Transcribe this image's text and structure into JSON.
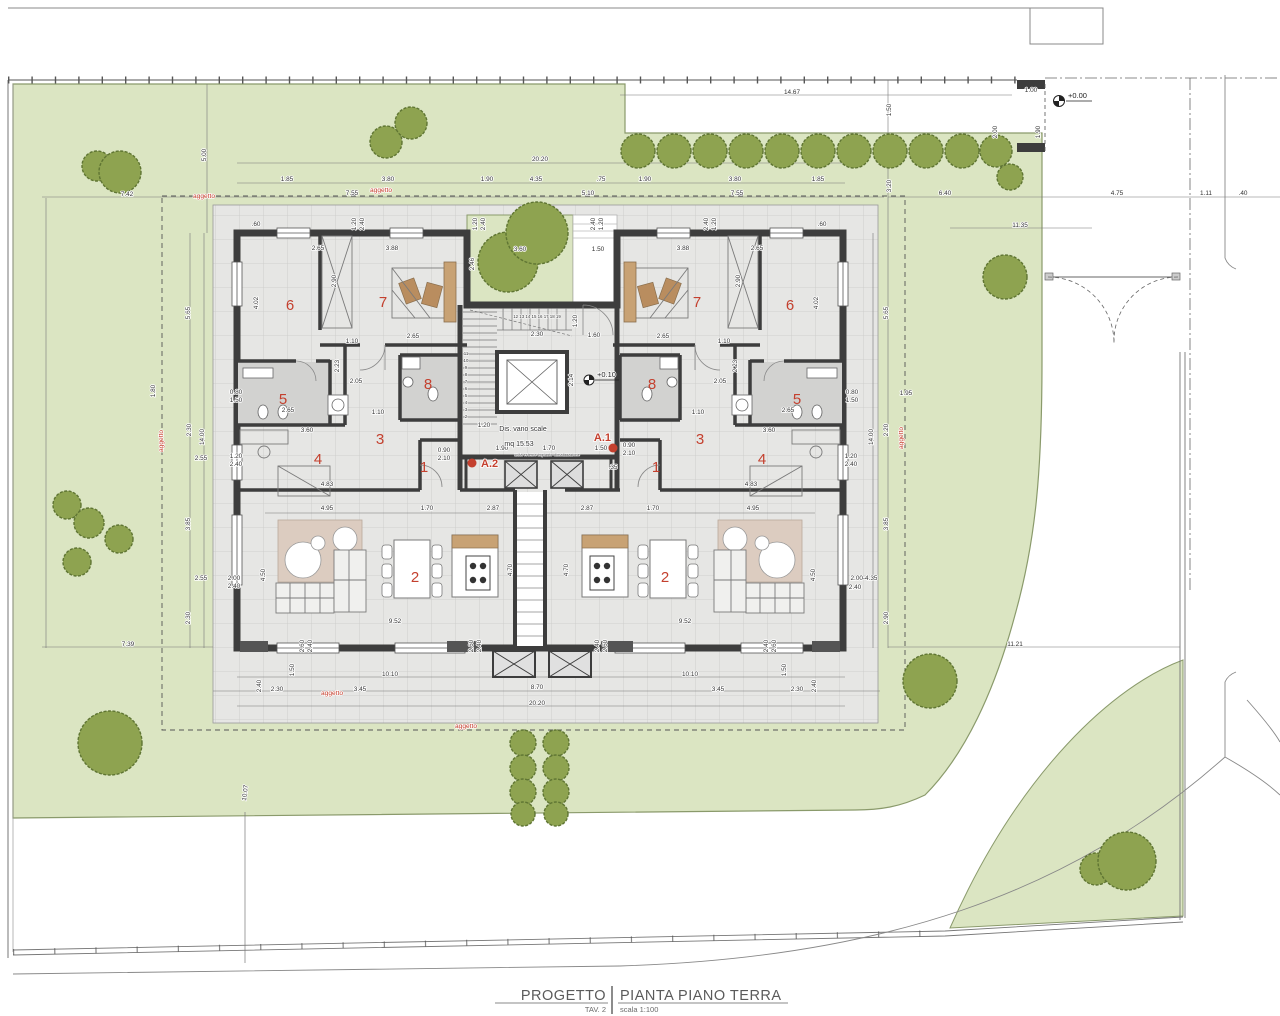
{
  "title_block": {
    "project_label": "PROGETTO",
    "drawing_title": "PIANTA PIANO TERRA",
    "sheet_label": "TAV. 2",
    "scale_label": "scala 1:100"
  },
  "notes": {
    "stair_line1": "Dis. vano scale",
    "stair_line2": "mq 15.53",
    "ac_units": "unità esterne impianto climatizzazione",
    "stair_top_numbers": "12 13 14 15 16 17 18 19"
  },
  "levels": {
    "ground": "+0.00",
    "entry": "+0.10"
  },
  "entrances": {
    "right": "A.1",
    "left": "A.2"
  },
  "colors": {
    "lawn": "#dbe5c2",
    "lawn_edge": "#8a9a6b",
    "tree_fill": "#8ea350",
    "tree_edge": "#5f7533",
    "paving": "#e6e6e4",
    "paving_grid": "#c9c9c7",
    "wall": "#3d3d3d",
    "red": "#c4402e",
    "bath_floor": "#d2d2d0",
    "wood": "#c8a274",
    "rug": "#dcccc0"
  },
  "annotations": {
    "dims": [
      [
        "14.67",
        792,
        94,
        0
      ],
      [
        "1.50",
        891,
        110,
        -90
      ],
      [
        "5.00",
        206,
        155,
        -90
      ],
      [
        "20.20",
        540,
        161,
        0
      ],
      [
        "1.85",
        287,
        181,
        0
      ],
      [
        "3.80",
        388,
        181,
        0
      ],
      [
        "1.90",
        487,
        181,
        0
      ],
      [
        "4.35",
        536,
        181,
        0
      ],
      [
        ".75",
        601,
        181,
        0
      ],
      [
        "1.90",
        645,
        181,
        0
      ],
      [
        "3.80",
        735,
        181,
        0
      ],
      [
        "1.85",
        818,
        181,
        0
      ],
      [
        "7.42",
        127,
        196,
        0
      ],
      [
        "7.55",
        352,
        195,
        0
      ],
      [
        "5.10",
        588,
        195,
        0
      ],
      [
        "7.55",
        737,
        195,
        0
      ],
      [
        "6.40",
        945,
        195,
        0
      ],
      [
        "3.20",
        891,
        186,
        -90
      ],
      [
        "4.75",
        1117,
        195,
        0
      ],
      [
        "1.11",
        1206,
        195,
        0
      ],
      [
        ".40",
        1243,
        195,
        0
      ],
      [
        "1.00",
        1031,
        92,
        0
      ],
      [
        "2.00",
        997,
        132,
        -90
      ],
      [
        "1.90",
        1040,
        132,
        -90
      ],
      [
        "11.35",
        1020,
        227,
        0
      ],
      [
        "5.65",
        190,
        313,
        -90
      ],
      [
        "1.80",
        155,
        391,
        -90
      ],
      [
        "0.80",
        236,
        394,
        0
      ],
      [
        "1.50",
        236,
        402,
        0
      ],
      [
        "2.30",
        191,
        430,
        -90
      ],
      [
        "14.00",
        204,
        437,
        -90
      ],
      [
        "2.55",
        201,
        460,
        0
      ],
      [
        "1.20",
        236,
        458,
        0
      ],
      [
        "2.40",
        236,
        466,
        0
      ],
      [
        "3.85",
        190,
        524,
        -90
      ],
      [
        "2.55",
        201,
        580,
        0
      ],
      [
        "2.00",
        234,
        580,
        0
      ],
      [
        "2.40",
        234,
        588,
        0
      ],
      [
        "2.30",
        190,
        618,
        -90
      ],
      [
        "7.39",
        128,
        646,
        0
      ],
      [
        "5.65",
        888,
        313,
        -90
      ],
      [
        "1.95",
        906,
        395,
        0
      ],
      [
        "0.80",
        852,
        394,
        0
      ],
      [
        "1.50",
        852,
        402,
        0
      ],
      [
        "2.20",
        888,
        430,
        -90
      ],
      [
        "14.00",
        873,
        437,
        -90
      ],
      [
        "1.20",
        851,
        458,
        0
      ],
      [
        "2.40",
        851,
        466,
        0
      ],
      [
        "3.85",
        888,
        524,
        -90
      ],
      [
        "2.00-4.35",
        864,
        580,
        0
      ],
      [
        "2.40",
        855,
        589,
        0
      ],
      [
        "2.90",
        888,
        618,
        -90
      ],
      [
        "11.21",
        1015,
        646,
        0
      ],
      [
        "2.40",
        261,
        686,
        -90
      ],
      [
        "2.30",
        277,
        691,
        0
      ],
      [
        "3.45",
        360,
        691,
        0
      ],
      [
        "10.10",
        390,
        676,
        0
      ],
      [
        "1.50",
        294,
        670,
        -90
      ],
      [
        "2.60",
        304,
        646,
        -90
      ],
      [
        "2.40",
        312,
        646,
        -90
      ],
      [
        "2.60",
        473,
        646,
        -90
      ],
      [
        "2.40",
        481,
        646,
        -90
      ],
      [
        "10.10",
        690,
        676,
        0
      ],
      [
        "3.45",
        718,
        691,
        0
      ],
      [
        "2.30",
        797,
        691,
        0
      ],
      [
        "2.40",
        816,
        686,
        -90
      ],
      [
        "2.60",
        776,
        646,
        -90
      ],
      [
        "2.40",
        768,
        646,
        -90
      ],
      [
        "2.60",
        607,
        646,
        -90
      ],
      [
        "2.40",
        599,
        646,
        -90
      ],
      [
        "1.50",
        786,
        670,
        -90
      ],
      [
        "8.70",
        537,
        689,
        0
      ],
      [
        "20.20",
        537,
        705,
        0
      ],
      [
        "10.07",
        247,
        793,
        -83
      ],
      [
        "2.65",
        318,
        250,
        0
      ],
      [
        "3.88",
        392,
        250,
        0
      ],
      [
        ".60",
        256,
        226,
        0
      ],
      [
        "1.20",
        356,
        224,
        -90
      ],
      [
        "2.40",
        364,
        224,
        -90
      ],
      [
        "1.20",
        477,
        224,
        -90
      ],
      [
        "2.40",
        485,
        224,
        -90
      ],
      [
        "2.46",
        474,
        264,
        -90
      ],
      [
        "3.60",
        520,
        251,
        0
      ],
      [
        "1.50",
        598,
        251,
        0
      ],
      [
        "4.02",
        258,
        303,
        -90
      ],
      [
        "2.90",
        336,
        281,
        -90
      ],
      [
        "1.10",
        352,
        343,
        0
      ],
      [
        "2.65",
        413,
        338,
        0
      ],
      [
        "2.23",
        339,
        366,
        -90
      ],
      [
        "2.05",
        356,
        383,
        0
      ],
      [
        "1.10",
        378,
        414,
        0
      ],
      [
        "3.60",
        307,
        432,
        0
      ],
      [
        "2.65",
        288,
        412,
        0
      ],
      [
        "0.90",
        444,
        452,
        0
      ],
      [
        "2.10",
        444,
        460,
        0
      ],
      [
        "4.83",
        327,
        486,
        0
      ],
      [
        "2.65",
        757,
        250,
        0
      ],
      [
        "3.88",
        683,
        250,
        0
      ],
      [
        ".60",
        822,
        226,
        0
      ],
      [
        "1.20",
        716,
        224,
        -90
      ],
      [
        "2.40",
        708,
        224,
        -90
      ],
      [
        "1.20",
        603,
        224,
        -90
      ],
      [
        "2.40",
        595,
        224,
        -90
      ],
      [
        "4.02",
        818,
        303,
        -90
      ],
      [
        "2.90",
        740,
        281,
        -90
      ],
      [
        "1.10",
        724,
        343,
        0
      ],
      [
        "2.65",
        663,
        338,
        0
      ],
      [
        "2.23",
        737,
        366,
        -90
      ],
      [
        "2.05",
        720,
        383,
        0
      ],
      [
        "1.10",
        698,
        414,
        0
      ],
      [
        "3.60",
        769,
        432,
        0
      ],
      [
        "2.65",
        788,
        412,
        0
      ],
      [
        "0.90",
        629,
        447,
        0
      ],
      [
        "2.10",
        629,
        455,
        0
      ],
      [
        "4.83",
        751,
        486,
        0
      ],
      [
        "2.30",
        537,
        336,
        0
      ],
      [
        "1.60",
        594,
        337,
        0
      ],
      [
        "1.20",
        577,
        321,
        -90
      ],
      [
        "2.14",
        573,
        380,
        -90
      ],
      [
        "1.20",
        484,
        427,
        0
      ],
      [
        "1.90",
        502,
        450,
        0
      ],
      [
        "1.70",
        549,
        450,
        0
      ],
      [
        "1.50",
        601,
        450,
        0
      ],
      [
        ".35",
        613,
        469,
        0
      ],
      [
        "4.95",
        327,
        510,
        0
      ],
      [
        "1.70",
        427,
        510,
        0
      ],
      [
        "2.87",
        493,
        510,
        0
      ],
      [
        "2.87",
        587,
        510,
        0
      ],
      [
        "1.70",
        653,
        510,
        0
      ],
      [
        "4.95",
        753,
        510,
        0
      ],
      [
        "4.50",
        265,
        575,
        -90
      ],
      [
        "4.70",
        512,
        570,
        -90
      ],
      [
        "4.70",
        568,
        570,
        -90
      ],
      [
        "4.50",
        815,
        575,
        -90
      ],
      [
        "9.52",
        395,
        623,
        0
      ],
      [
        "9.52",
        685,
        623,
        0
      ]
    ],
    "red_labels": [
      [
        "aggetto",
        204,
        198,
        0
      ],
      [
        "aggetto",
        381,
        192,
        0
      ],
      [
        "aggetto",
        163,
        441,
        -90
      ],
      [
        "aggetto",
        903,
        438,
        -90
      ],
      [
        "aggetto",
        332,
        695,
        0
      ],
      [
        "aggetto",
        466,
        728,
        0
      ]
    ],
    "room_numbers": [
      [
        "6",
        290,
        310
      ],
      [
        "7",
        383,
        307
      ],
      [
        "5",
        283,
        404
      ],
      [
        "8",
        428,
        389
      ],
      [
        "3",
        380,
        444
      ],
      [
        "4",
        318,
        464
      ],
      [
        "1",
        424,
        472
      ],
      [
        "2",
        415,
        582
      ],
      [
        "7",
        697,
        307
      ],
      [
        "6",
        790,
        310
      ],
      [
        "8",
        652,
        389
      ],
      [
        "5",
        797,
        404
      ],
      [
        "3",
        700,
        444
      ],
      [
        "4",
        762,
        464
      ],
      [
        "1",
        656,
        472
      ],
      [
        "2",
        665,
        582
      ]
    ],
    "stair_side_numbers": [
      [
        "11",
        466,
        355
      ],
      [
        "10",
        466,
        362
      ],
      [
        "9",
        466,
        369
      ],
      [
        "8",
        466,
        376
      ],
      [
        "7",
        466,
        383
      ],
      [
        "6",
        466,
        390
      ],
      [
        "5",
        466,
        397
      ],
      [
        "4",
        466,
        404
      ],
      [
        "3",
        466,
        411
      ],
      [
        "2",
        466,
        418
      ]
    ]
  },
  "site": {
    "trees": [
      [
        97,
        166,
        15
      ],
      [
        120,
        172,
        21
      ],
      [
        386,
        142,
        16
      ],
      [
        411,
        123,
        16
      ],
      [
        508,
        262,
        30
      ],
      [
        537,
        233,
        31
      ],
      [
        1010,
        177,
        13
      ],
      [
        1005,
        277,
        22
      ],
      [
        67,
        505,
        14
      ],
      [
        89,
        523,
        15
      ],
      [
        119,
        539,
        14
      ],
      [
        77,
        562,
        14
      ],
      [
        110,
        743,
        32
      ],
      [
        930,
        681,
        27
      ],
      [
        1096,
        869,
        16
      ],
      [
        1127,
        861,
        29
      ]
    ],
    "hedge_top": [
      [
        638,
        151,
        17
      ],
      [
        674,
        151,
        17
      ],
      [
        710,
        151,
        17
      ],
      [
        746,
        151,
        17
      ],
      [
        782,
        151,
        17
      ],
      [
        818,
        151,
        17
      ],
      [
        854,
        151,
        17
      ],
      [
        890,
        151,
        17
      ],
      [
        926,
        151,
        17
      ],
      [
        962,
        151,
        17
      ],
      [
        996,
        151,
        16
      ]
    ],
    "hedge_bottom": [
      [
        523,
        743,
        13
      ],
      [
        556,
        743,
        13
      ],
      [
        523,
        768,
        13
      ],
      [
        556,
        768,
        13
      ],
      [
        523,
        792,
        13
      ],
      [
        556,
        792,
        13
      ],
      [
        523,
        814,
        12
      ],
      [
        556,
        814,
        12
      ]
    ]
  }
}
